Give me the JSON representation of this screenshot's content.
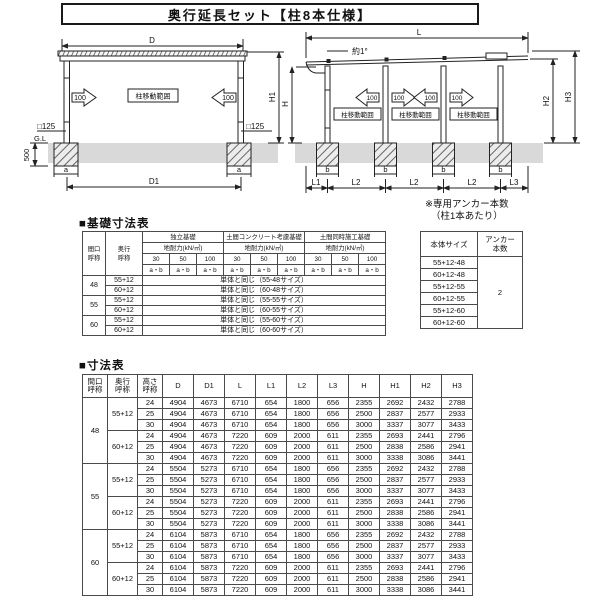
{
  "page": {
    "title": "奥行延長セット【柱8本仕様】"
  },
  "diagrams": {
    "move_range_label": "柱移動範囲",
    "move_amount": "100",
    "front_view": {
      "dim_top": "D",
      "dim_bottom": "D1",
      "dim_height": "H1",
      "pillar_size": "□125",
      "ground_level": "G.L",
      "foundation_depth": "500",
      "foundation_width": "a"
    },
    "side_view": {
      "dim_top": "L",
      "slope": "約1°",
      "dim_h": "H",
      "dim_h2": "H2",
      "dim_h3": "H3",
      "foundation_width": "b",
      "dim_l1": "L1",
      "dim_l2": "L2",
      "dim_l3": "L3"
    }
  },
  "foundation_table": {
    "title": "■基礎寸法表",
    "col_maguchi": "間口\n呼称",
    "col_okuyuki": "奥行\n呼称",
    "group_headers": [
      "独立基礎",
      "土間コンクリート考慮基礎",
      "土間同時施工基礎"
    ],
    "subheader": "地耐力(kN/㎡)",
    "loads": [
      "30",
      "50",
      "100"
    ],
    "ab": "a・b",
    "groups": [
      {
        "maguchi": "48",
        "rows": [
          {
            "okuyuki": "55+12",
            "value": "単体と同じ（55-48サイズ）"
          },
          {
            "okuyuki": "60+12",
            "value": "単体と同じ（60-48サイズ）"
          }
        ]
      },
      {
        "maguchi": "55",
        "rows": [
          {
            "okuyuki": "55+12",
            "value": "単体と同じ（55-55サイズ）"
          },
          {
            "okuyuki": "60+12",
            "value": "単体と同じ（60-55サイズ）"
          }
        ]
      },
      {
        "maguchi": "60",
        "rows": [
          {
            "okuyuki": "55+12",
            "value": "単体と同じ（55-60サイズ）"
          },
          {
            "okuyuki": "60+12",
            "value": "単体と同じ（60-60サイズ）"
          }
        ]
      }
    ]
  },
  "anchor_note": {
    "line1": "※専用アンカー本数",
    "line2": "（柱1本あたり）"
  },
  "anchor_table": {
    "col_size": "本体サイズ",
    "col_count": "アンカー\n本数",
    "sizes": [
      "55+12-48",
      "60+12-48",
      "55+12-55",
      "60+12-55",
      "55+12-60",
      "60+12-60"
    ],
    "count": "2"
  },
  "dim_table": {
    "title": "■寸法表",
    "headers": [
      "間口\n呼称",
      "奥行\n呼称",
      "高さ\n呼称",
      "D",
      "D1",
      "L",
      "L1",
      "L2",
      "L3",
      "H",
      "H1",
      "H2",
      "H3"
    ],
    "groups": [
      {
        "maguchi": "48",
        "subs": [
          {
            "okuyuki": "55+12",
            "rows": [
              [
                "24",
                "4904",
                "4673",
                "6710",
                "654",
                "1800",
                "656",
                "2355",
                "2692",
                "2432",
                "2788"
              ],
              [
                "25",
                "4904",
                "4673",
                "6710",
                "654",
                "1800",
                "656",
                "2500",
                "2837",
                "2577",
                "2933"
              ],
              [
                "30",
                "4904",
                "4673",
                "6710",
                "654",
                "1800",
                "656",
                "3000",
                "3337",
                "3077",
                "3433"
              ]
            ]
          },
          {
            "okuyuki": "60+12",
            "rows": [
              [
                "24",
                "4904",
                "4673",
                "7220",
                "609",
                "2000",
                "611",
                "2355",
                "2693",
                "2441",
                "2796"
              ],
              [
                "25",
                "4904",
                "4673",
                "7220",
                "609",
                "2000",
                "611",
                "2500",
                "2838",
                "2586",
                "2941"
              ],
              [
                "30",
                "4904",
                "4673",
                "7220",
                "609",
                "2000",
                "611",
                "3000",
                "3338",
                "3086",
                "3441"
              ]
            ]
          }
        ]
      },
      {
        "maguchi": "55",
        "subs": [
          {
            "okuyuki": "55+12",
            "rows": [
              [
                "24",
                "5504",
                "5273",
                "6710",
                "654",
                "1800",
                "656",
                "2355",
                "2692",
                "2432",
                "2788"
              ],
              [
                "25",
                "5504",
                "5273",
                "6710",
                "654",
                "1800",
                "656",
                "2500",
                "2837",
                "2577",
                "2933"
              ],
              [
                "30",
                "5504",
                "5273",
                "6710",
                "654",
                "1800",
                "656",
                "3000",
                "3337",
                "3077",
                "3433"
              ]
            ]
          },
          {
            "okuyuki": "60+12",
            "rows": [
              [
                "24",
                "5504",
                "5273",
                "7220",
                "609",
                "2000",
                "611",
                "2355",
                "2693",
                "2441",
                "2796"
              ],
              [
                "25",
                "5504",
                "5273",
                "7220",
                "609",
                "2000",
                "611",
                "2500",
                "2838",
                "2586",
                "2941"
              ],
              [
                "30",
                "5504",
                "5273",
                "7220",
                "609",
                "2000",
                "611",
                "3000",
                "3338",
                "3086",
                "3441"
              ]
            ]
          }
        ]
      },
      {
        "maguchi": "60",
        "subs": [
          {
            "okuyuki": "55+12",
            "rows": [
              [
                "24",
                "6104",
                "5873",
                "6710",
                "654",
                "1800",
                "656",
                "2355",
                "2692",
                "2432",
                "2788"
              ],
              [
                "25",
                "6104",
                "5873",
                "6710",
                "654",
                "1800",
                "656",
                "2500",
                "2837",
                "2577",
                "2933"
              ],
              [
                "30",
                "6104",
                "5873",
                "6710",
                "654",
                "1800",
                "656",
                "3000",
                "3337",
                "3077",
                "3433"
              ]
            ]
          },
          {
            "okuyuki": "60+12",
            "rows": [
              [
                "24",
                "6104",
                "5873",
                "7220",
                "609",
                "2000",
                "611",
                "2355",
                "2693",
                "2441",
                "2796"
              ],
              [
                "25",
                "6104",
                "5873",
                "7220",
                "609",
                "2000",
                "611",
                "2500",
                "2838",
                "2586",
                "2941"
              ],
              [
                "30",
                "6104",
                "5873",
                "7220",
                "609",
                "2000",
                "611",
                "3000",
                "3338",
                "3086",
                "3441"
              ]
            ]
          }
        ]
      }
    ]
  }
}
